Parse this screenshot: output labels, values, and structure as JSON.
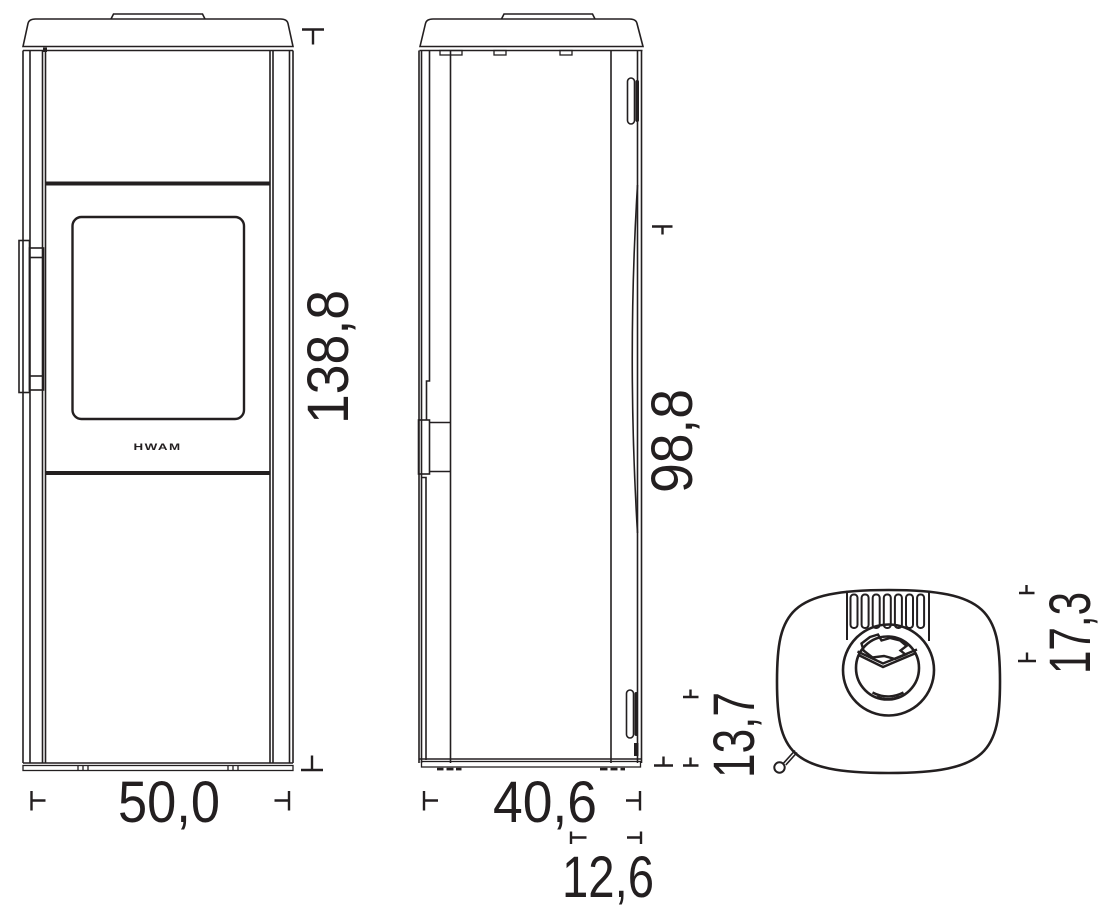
{
  "drawing": {
    "background_color": "#ffffff",
    "line_color": "#231f20",
    "brand_logo": "HWAM",
    "dimensions": {
      "front_width": "50,0",
      "front_height": "138,8",
      "side_depth": "40,6",
      "side_rear_height": "98,8",
      "side_bottom_offset": "12,6",
      "side_rear_clearance": "13,7",
      "top_flue_offset": "17,3"
    }
  }
}
